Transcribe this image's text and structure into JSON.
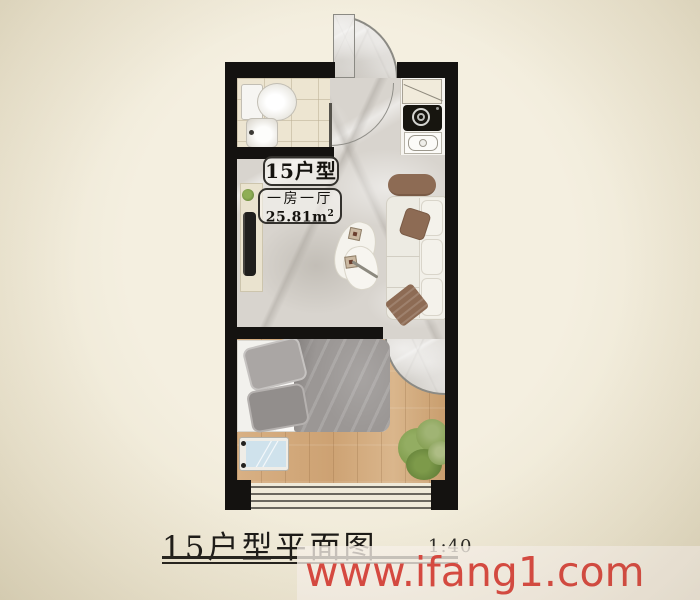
{
  "plan": {
    "unit_label": "15户型",
    "layout_label": "一房一厅",
    "area_label": "25.81m",
    "area_superscript": "2"
  },
  "footer": {
    "title": "15户型平面图",
    "scale": "1:40"
  },
  "watermark": {
    "text": "www.ifang1.com",
    "color": "#d84840"
  },
  "colors": {
    "background": "#f0ebda",
    "wall": "#141210",
    "marble_floor": "#d8d4ce",
    "bathroom_tile": "#ede5d1",
    "wood_floor": "#d2a87a",
    "sofa_accent_brown": "#8d6b54",
    "bed_duvet_gray": "#9b9795",
    "plant_green": "#7d9a4a",
    "watermark_red": "#d84840"
  },
  "furniture": [
    "entry-door",
    "toilet",
    "bathroom-sink",
    "kitchen-cabinet",
    "cooktop",
    "kitchen-sink",
    "sofa",
    "coffee-table",
    "tv-console",
    "television",
    "bed",
    "bedroom-tv",
    "plant",
    "window"
  ]
}
